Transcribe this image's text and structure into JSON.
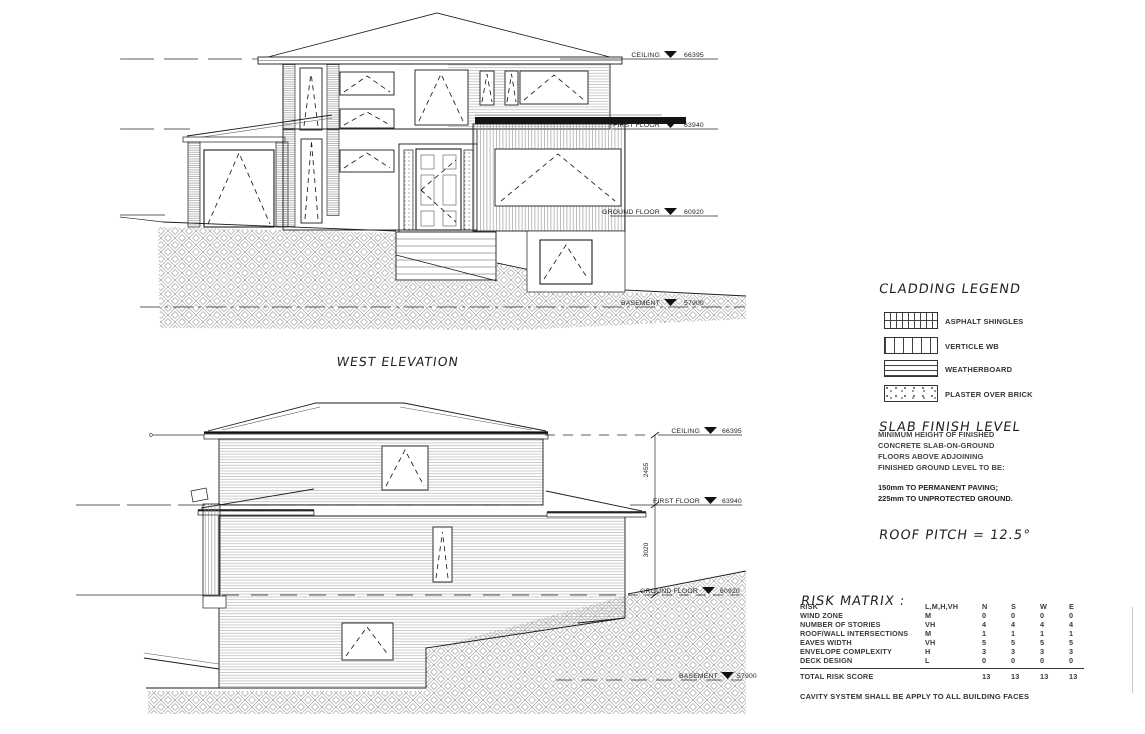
{
  "west_elevation": {
    "title": "WEST ELEVATION",
    "levels": [
      {
        "label": "CEILING",
        "value": "66395"
      },
      {
        "label": "FIRST FLOOR",
        "value": "63940"
      },
      {
        "label": "GROUND FLOOR",
        "value": "60920"
      },
      {
        "label": "BASEMENT",
        "value": "57900"
      }
    ]
  },
  "side_elevation": {
    "levels": [
      {
        "label": "CEILING",
        "value": "66395"
      },
      {
        "label": "FIRST FLOOR",
        "value": "63940"
      },
      {
        "label": "GROUND FLOOR",
        "value": "60920"
      },
      {
        "label": "BASEMENT",
        "value": "57900"
      }
    ],
    "dimensions": [
      "2455",
      "3020"
    ]
  },
  "cladding_legend": {
    "title": "CLADDING LEGEND",
    "items": [
      {
        "label": "ASPHALT SHINGLES"
      },
      {
        "label": "VERTICLE WB"
      },
      {
        "label": "WEATHERBOARD"
      },
      {
        "label": "PLASTER OVER BRICK"
      }
    ]
  },
  "slab_finish_level": {
    "title": "SLAB FINISH LEVEL",
    "note_lines": [
      "MINIMUM HEIGHT OF FINISHED",
      "CONCRETE SLAB-ON-GROUND",
      "FLOORS ABOVE ADJOINING",
      "FINISHED GROUND LEVEL TO BE:"
    ],
    "requirements": [
      "150mm TO PERMANENT PAVING;",
      "225mm TO UNPROTECTED GROUND."
    ]
  },
  "roof_pitch": {
    "text": "ROOF PITCH = 12.5°"
  },
  "risk_matrix": {
    "title": "RISK MATRIX :",
    "header": {
      "col_risk": "RISK",
      "col_grades": "L,M,H,VH",
      "col_n": "N",
      "col_s": "S",
      "col_w": "W",
      "col_e": "E"
    },
    "rows": [
      [
        "WIND ZONE",
        "M",
        "0",
        "0",
        "0",
        "0"
      ],
      [
        "NUMBER OF STORIES",
        "VH",
        "4",
        "4",
        "4",
        "4"
      ],
      [
        "ROOF/WALL INTERSECTIONS",
        "M",
        "1",
        "1",
        "1",
        "1"
      ],
      [
        "EAVES WIDTH",
        "VH",
        "5",
        "5",
        "5",
        "5"
      ],
      [
        "ENVELOPE COMPLEXITY",
        "H",
        "3",
        "3",
        "3",
        "3"
      ],
      [
        "DECK DESIGN",
        "L",
        "0",
        "0",
        "0",
        "0"
      ]
    ],
    "total_label": "TOTAL RISK SCORE",
    "total_values": [
      "13",
      "13",
      "13",
      "13"
    ],
    "footer": "CAVITY SYSTEM SHALL BE APPLY TO ALL BUILDING FACES"
  }
}
